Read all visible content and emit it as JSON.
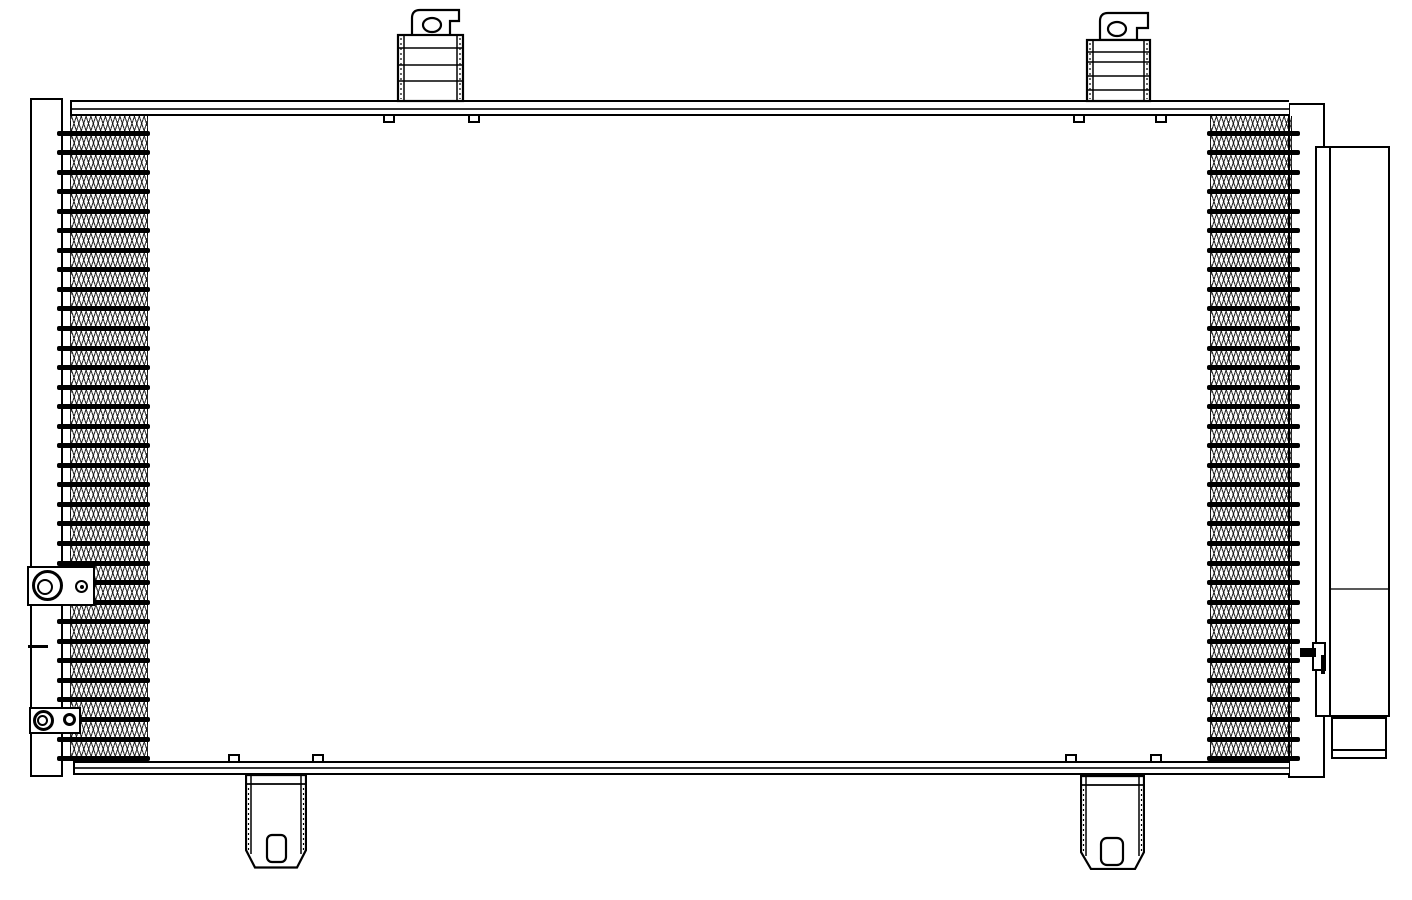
{
  "canvas": {
    "width": 1412,
    "height": 900,
    "background": "#ffffff",
    "ink": "#000000"
  },
  "diagram": {
    "kind": "condenser-technical-line-drawing",
    "core": {
      "tube_rows": 33,
      "fin_zones": 2
    },
    "mounts": {
      "top_brackets": 2,
      "bottom_brackets": 2
    },
    "receiver_drier_count": 1,
    "left_port_fittings": 2
  }
}
